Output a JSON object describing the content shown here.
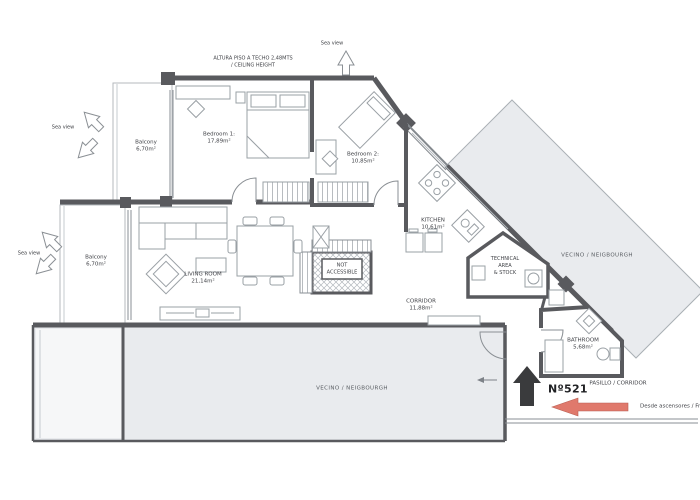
{
  "plan": {
    "annotations": {
      "ceiling_line1": "ALTURA PISO A TECHO 2,48MTS",
      "ceiling_line2": "/   CEILING HEIGHT",
      "sea_view": "Sea view"
    },
    "rooms": {
      "balcony_top": {
        "name": "Balcony",
        "area": "6,70m²"
      },
      "bedroom1": {
        "name": "Bedroom 1:",
        "area": "17,89m²"
      },
      "bedroom2": {
        "name": "Bedroom 2:",
        "area": "10,85m²"
      },
      "kitchen": {
        "name": "KITCHEN",
        "area": "10,61m²"
      },
      "balcony_bottom": {
        "name": "Balcony",
        "area": "6,70m²"
      },
      "living_room": {
        "name": "LIVING ROOM",
        "area": "21,14m²"
      },
      "corridor": {
        "name": "CORRIDOR",
        "area": "11,88m²"
      },
      "bathroom": {
        "name": "BATHROOM",
        "area": "5,68m²"
      },
      "technical_area": {
        "line1": "TECHNICAL",
        "line2": "AREA",
        "line3": "&  STOCK"
      },
      "not_accessible": {
        "line1": "NOT",
        "line2": "ACCESSIBLE"
      }
    },
    "neighbours": {
      "diagonal": "VECINO / NEIGBOURGH",
      "bottom": "VECINO / NEIGBOURGH",
      "pasillo": "PASILLO / CORRIDOR"
    },
    "entrance": {
      "unit": "Nº521",
      "from_lifts": "Desde ascensores / From lifts"
    },
    "colors": {
      "wall": "#595a5e",
      "neighbour_fill": "#e9ebee",
      "entrance_arrow": "#3a3b3d",
      "lifts_arrow": "#e0796c"
    }
  }
}
